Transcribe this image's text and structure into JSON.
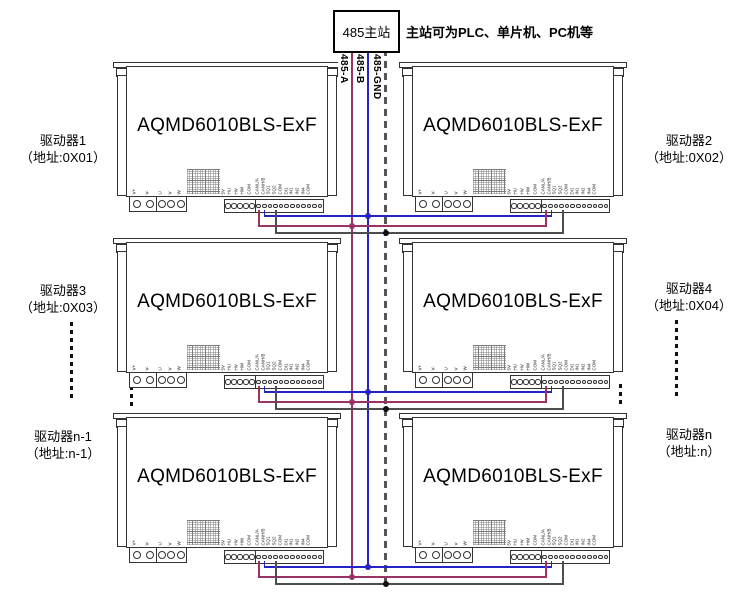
{
  "master": {
    "label": "485主站",
    "note": "主站可为PLC、单片机、PC机等"
  },
  "bus": {
    "lines": [
      {
        "name": "485-A",
        "color": "#993366",
        "style": "solid"
      },
      {
        "name": "485-B",
        "color": "#2323C8",
        "style": "solid"
      },
      {
        "name": "485-GND",
        "color": "#555555",
        "style": "dashed"
      }
    ]
  },
  "drivers": [
    {
      "model": "AQMD6010BLS-ExF"
    },
    {
      "model": "AQMD6010BLS-ExF"
    },
    {
      "model": "AQMD6010BLS-ExF"
    },
    {
      "model": "AQMD6010BLS-ExF"
    },
    {
      "model": "AQMD6010BLS-ExF"
    },
    {
      "model": "AQMD6010BLS-ExF"
    }
  ],
  "labels": [
    {
      "line1": "驱动器1",
      "line2": "（地址:0X01）"
    },
    {
      "line1": "驱动器2",
      "line2": "（地址:0X02）"
    },
    {
      "line1": "驱动器3",
      "line2": "（地址:0X03）"
    },
    {
      "line1": "驱动器4",
      "line2": "（地址:0X04）"
    },
    {
      "line1": "驱动器n-1",
      "line2": "（地址:n-1）"
    },
    {
      "line1": "驱动器n",
      "line2": "（地址:n）"
    }
  ],
  "pins": {
    "power": [
      "V+",
      "V-",
      "U",
      "V",
      "W"
    ],
    "hall": [
      "5V",
      "HU",
      "HV",
      "HW",
      "COM"
    ],
    "signal": [
      "CANL/A",
      "CANH/B",
      "SQ1",
      "SQ2",
      "COM",
      "DI1",
      "IN1",
      "IN2",
      "IN4",
      "COM"
    ]
  }
}
